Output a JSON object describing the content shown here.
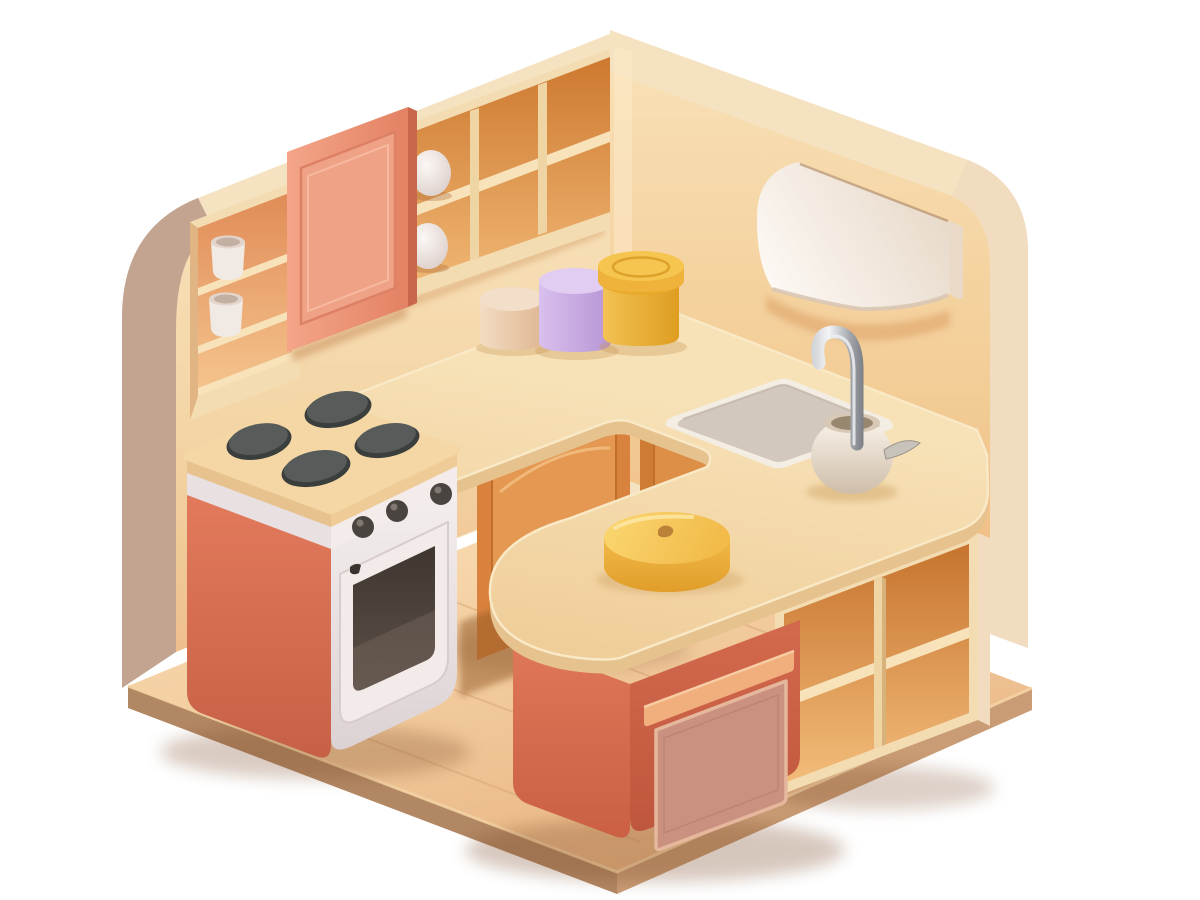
{
  "scene": {
    "type": "3d-isometric-illustration",
    "subject": "toy kitchen interior",
    "background": "#FFFFFF",
    "objects": [
      "left-wall",
      "right-wall",
      "wall-niche-shelf",
      "white-canisters",
      "wall-cabinet-door",
      "wall-cubby-shelves",
      "eggs",
      "range-hood",
      "stove-oven",
      "burners",
      "corner-cabinet-door",
      "under-sink-cabinet-door",
      "l-shaped-countertop",
      "sink-basin",
      "chrome-faucet",
      "faucet-pot",
      "storage-jars",
      "kitchen-island",
      "island-door",
      "island-cubby-shelves",
      "butter-dish",
      "wood-floor"
    ]
  },
  "palette": {
    "wallCream": "#F5E2C0",
    "leftWallStrip": "#C2A491",
    "rightWallStrip": "#F1DCC0",
    "cornerGlow": "#FBEAC9",
    "floorEdgeFront": "#B28764",
    "floorEdgeRight": "#C99C75",
    "floorLip": "#F4D3A3",
    "floorLine": "#D9A878",
    "frameCream": "#F4DCB2",
    "shelfCream": "#F7E2BA",
    "dividerCream": "#EFD4A4",
    "dividerShade": "#D8B27B",
    "cubbyGapShadow": "#8F5526",
    "cabinetShadow": "#925827",
    "doorOrange": "#D8823E",
    "doorOrangePanel": "#E49851",
    "doorOrangeStroke": "#C06F2A",
    "underSinkDoor": "#CE7C34",
    "underSinkPanel": "#DD8F48",
    "salmonDoorSide": "#C9674C",
    "salmonDoorPanel": "#F0A287",
    "salmonDoorStroke": "#DD8166",
    "handleWhite": "#F3EEE9",
    "handleStroke": "#C9BCB4",
    "burnerRim": "#3A3E3C",
    "burnerTop": "#575C5A",
    "burnerHi": "#7E8381",
    "knobDark": "#4A4440",
    "knobHi": "#8D847C",
    "slabEdgeL": "#E8C28E",
    "slabEdgeR": "#EFCB97",
    "stoveBandL": "#E9E1E1",
    "stoveBandR": "#F3ECEB",
    "ovenFrame": "#F2EBE9",
    "ovenFrameShade": "#D8CCCC",
    "ovenReflect": "#6E6057",
    "latchDark": "#3A332E",
    "sinkRim": "#F4EDE3",
    "sinkBasin": "#D2C8BD",
    "sinkInnerLine": "#B5AB9F",
    "potOpen": "#D8C9B6",
    "potInner": "#97876F",
    "spoonGray": "#C7C2BA",
    "spoonStroke": "#9A948A",
    "cupWhite": "#F1E9E4",
    "cupRim": "#E3D5CB",
    "cupRimInner": "#C2B1A3",
    "counterEdge": "#E6C28F",
    "counterLip": "#F9E9C6",
    "islandRail": "#F1AF7E",
    "islandRailLip": "#F8CDA4",
    "islandPanel": "#CB9180",
    "islandPanelBorder": "#E5B89E",
    "islandPanelLine": "#B87E6E",
    "hoodSide": "#E9D9C6",
    "hoodShadow": "#D99A5E",
    "hoodSlot": "#A67848",
    "hoodLip": "#D9C7B4",
    "cakeBottom": "#E4A42E",
    "cakeHi": "#FCE9A8",
    "cakeNub": "#BC8338",
    "jarLidYellow": "#F5C54F",
    "jarLidRing": "#D89820",
    "jarTopPurple": "#E1CCF2",
    "jarTopBeige": "#F2DEC9",
    "shadowBrown": "#7A4A28",
    "contactShadow": "#C89858",
    "nicheReveal": "#D9A873",
    "doorHangShadow": "#C0804E",
    "cubbyDropShadow": "#D29A62"
  }
}
